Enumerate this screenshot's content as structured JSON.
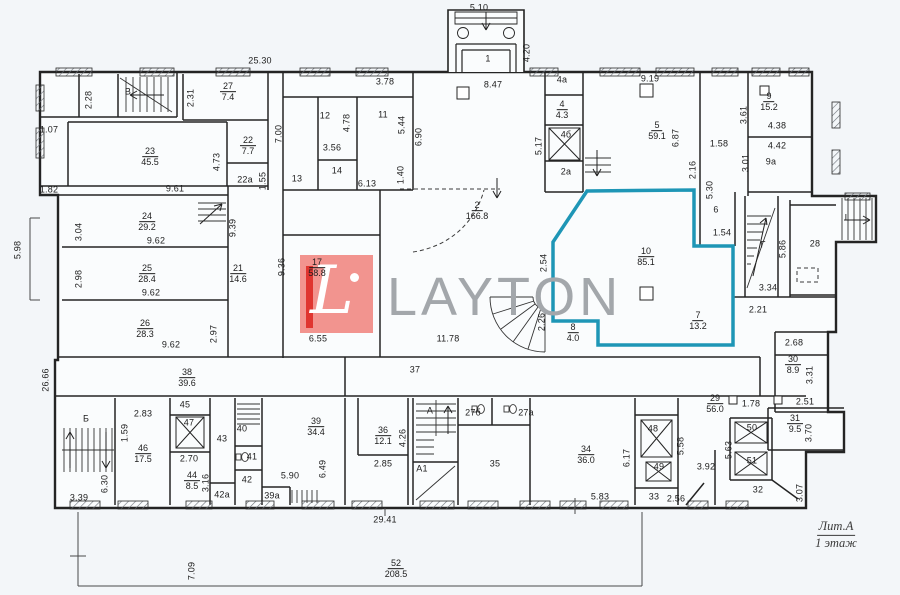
{
  "meta": {
    "logo_text": "LAYTON",
    "logo_letter": "L",
    "litera": "Лит.А",
    "floor": "1 этаж"
  },
  "colors": {
    "highlight_teal": "#1e96b6",
    "logo_pink": "#f2948f",
    "logo_red": "#e03530",
    "logo_grey": "#a3a7ab",
    "line": "#242424",
    "paper": "#fafcfd"
  },
  "highlighted_room": {
    "num": "10",
    "area": "85.1"
  },
  "rooms": [
    {
      "n": "27",
      "a": "7.4",
      "x": 228,
      "y": 92
    },
    {
      "n": "23",
      "a": "45.5",
      "x": 150,
      "y": 157
    },
    {
      "n": "22",
      "a": "7.7",
      "x": 248,
      "y": 146
    },
    {
      "n": "4",
      "a": "4.3",
      "x": 562,
      "y": 110
    },
    {
      "n": "5",
      "a": "59.1",
      "x": 657,
      "y": 131
    },
    {
      "n": "9",
      "a": "15.2",
      "x": 769,
      "y": 102
    },
    {
      "n": "24",
      "a": "29.2",
      "x": 147,
      "y": 222
    },
    {
      "n": "25",
      "a": "28.4",
      "x": 147,
      "y": 274
    },
    {
      "n": "26",
      "a": "28.3",
      "x": 145,
      "y": 329
    },
    {
      "n": "21",
      "a": "14.6",
      "x": 238,
      "y": 274
    },
    {
      "n": "17",
      "a": "58.8",
      "x": 317,
      "y": 268
    },
    {
      "n": "2",
      "a": "166.8",
      "x": 477,
      "y": 211
    },
    {
      "n": "10",
      "a": "85.1",
      "x": 646,
      "y": 257
    },
    {
      "n": "7",
      "a": "13.2",
      "x": 698,
      "y": 321
    },
    {
      "n": "8",
      "a": "4.0",
      "x": 573,
      "y": 333
    },
    {
      "n": "38",
      "a": "39.6",
      "x": 187,
      "y": 378
    },
    {
      "n": "46",
      "a": "17.5",
      "x": 143,
      "y": 454
    },
    {
      "n": "44",
      "a": "8.5",
      "x": 192,
      "y": 481
    },
    {
      "n": "39",
      "a": "34.4",
      "x": 316,
      "y": 427
    },
    {
      "n": "36",
      "a": "12.1",
      "x": 383,
      "y": 436
    },
    {
      "n": "34",
      "a": "36.0",
      "x": 586,
      "y": 455
    },
    {
      "n": "29",
      "a": "56.0",
      "x": 715,
      "y": 404
    },
    {
      "n": "31",
      "a": "9.5",
      "x": 795,
      "y": 424
    },
    {
      "n": "30",
      "a": "8.9",
      "x": 793,
      "y": 365
    },
    {
      "n": "52",
      "a": "208.5",
      "x": 396,
      "y": 569
    }
  ],
  "labels": [
    {
      "t": "25.30",
      "x": 260,
      "y": 61
    },
    {
      "t": "5.10",
      "x": 479,
      "y": 8
    },
    {
      "t": "4.20",
      "x": 527,
      "y": 53,
      "r": 1
    },
    {
      "t": "8.47",
      "x": 493,
      "y": 85
    },
    {
      "t": "3.78",
      "x": 385,
      "y": 82
    },
    {
      "t": "1",
      "x": 488,
      "y": 59
    },
    {
      "t": "2.28",
      "x": 89,
      "y": 100,
      "r": 1
    },
    {
      "t": "В",
      "x": 128,
      "y": 92
    },
    {
      "t": "2.31",
      "x": 191,
      "y": 98,
      "r": 1
    },
    {
      "t": "1.07",
      "x": 49,
      "y": 130
    },
    {
      "t": "1.82",
      "x": 49,
      "y": 190
    },
    {
      "t": "7.00",
      "x": 279,
      "y": 134,
      "r": 1
    },
    {
      "t": "4.73",
      "x": 217,
      "y": 162,
      "r": 1
    },
    {
      "t": "22а",
      "x": 245,
      "y": 180
    },
    {
      "t": "1.55",
      "x": 263,
      "y": 181,
      "r": 1
    },
    {
      "t": "9.61",
      "x": 175,
      "y": 189
    },
    {
      "t": "12",
      "x": 325,
      "y": 116
    },
    {
      "t": "11",
      "x": 383,
      "y": 115
    },
    {
      "t": "4.78",
      "x": 347,
      "y": 123,
      "r": 1
    },
    {
      "t": "5.44",
      "x": 402,
      "y": 125,
      "r": 1
    },
    {
      "t": "6.90",
      "x": 419,
      "y": 137,
      "r": 1
    },
    {
      "t": "3.56",
      "x": 332,
      "y": 148
    },
    {
      "t": "14",
      "x": 337,
      "y": 171
    },
    {
      "t": "13",
      "x": 297,
      "y": 179
    },
    {
      "t": "6.13",
      "x": 367,
      "y": 184
    },
    {
      "t": "1.40",
      "x": 401,
      "y": 175,
      "r": 1
    },
    {
      "t": "5.17",
      "x": 539,
      "y": 146,
      "r": 1
    },
    {
      "t": "4а",
      "x": 562,
      "y": 80
    },
    {
      "t": "4б",
      "x": 566,
      "y": 135
    },
    {
      "t": "2а",
      "x": 566,
      "y": 172
    },
    {
      "t": "9.19",
      "x": 650,
      "y": 79
    },
    {
      "t": "6.87",
      "x": 676,
      "y": 138,
      "r": 1
    },
    {
      "t": "1.58",
      "x": 719,
      "y": 144
    },
    {
      "t": "2.16",
      "x": 693,
      "y": 170,
      "r": 1
    },
    {
      "t": "5.30",
      "x": 710,
      "y": 190,
      "r": 1
    },
    {
      "t": "3.61",
      "x": 744,
      "y": 115,
      "r": 1
    },
    {
      "t": "3.01",
      "x": 746,
      "y": 163,
      "r": 1
    },
    {
      "t": "4.38",
      "x": 777,
      "y": 126
    },
    {
      "t": "4.42",
      "x": 777,
      "y": 146
    },
    {
      "t": "9а",
      "x": 771,
      "y": 162
    },
    {
      "t": "6",
      "x": 716,
      "y": 210
    },
    {
      "t": "1.54",
      "x": 722,
      "y": 233
    },
    {
      "t": "I",
      "x": 846,
      "y": 218
    },
    {
      "t": "Г",
      "x": 763,
      "y": 245
    },
    {
      "t": "5.86",
      "x": 783,
      "y": 249,
      "r": 1
    },
    {
      "t": "28",
      "x": 815,
      "y": 244
    },
    {
      "t": "3.34",
      "x": 768,
      "y": 288
    },
    {
      "t": "2.21",
      "x": 758,
      "y": 310
    },
    {
      "t": "2.68",
      "x": 794,
      "y": 343
    },
    {
      "t": "3.31",
      "x": 810,
      "y": 375,
      "r": 1
    },
    {
      "t": "3.04",
      "x": 79,
      "y": 232,
      "r": 1
    },
    {
      "t": "9.62",
      "x": 156,
      "y": 241
    },
    {
      "t": "2.98",
      "x": 79,
      "y": 279,
      "r": 1
    },
    {
      "t": "9.62",
      "x": 151,
      "y": 293
    },
    {
      "t": "9.62",
      "x": 171,
      "y": 345
    },
    {
      "t": "2.97",
      "x": 214,
      "y": 334,
      "r": 1
    },
    {
      "t": "9.39",
      "x": 233,
      "y": 228,
      "r": 1
    },
    {
      "t": "9.36",
      "x": 282,
      "y": 267,
      "r": 1
    },
    {
      "t": "5.98",
      "x": 18,
      "y": 250,
      "r": 1
    },
    {
      "t": "26.66",
      "x": 46,
      "y": 380,
      "r": 1
    },
    {
      "t": "2.54",
      "x": 544,
      "y": 263,
      "r": 1
    },
    {
      "t": "2.26",
      "x": 542,
      "y": 322,
      "r": 1
    },
    {
      "t": "6.55",
      "x": 318,
      "y": 339
    },
    {
      "t": "11.78",
      "x": 448,
      "y": 339
    },
    {
      "t": "37",
      "x": 415,
      "y": 370
    },
    {
      "t": "Б",
      "x": 86,
      "y": 419
    },
    {
      "t": "2.83",
      "x": 143,
      "y": 414
    },
    {
      "t": "1.59",
      "x": 125,
      "y": 433,
      "r": 1
    },
    {
      "t": "45",
      "x": 185,
      "y": 405
    },
    {
      "t": "47",
      "x": 189,
      "y": 423
    },
    {
      "t": "43",
      "x": 222,
      "y": 439
    },
    {
      "t": "40",
      "x": 242,
      "y": 429
    },
    {
      "t": "41",
      "x": 252,
      "y": 457
    },
    {
      "t": "42",
      "x": 247,
      "y": 480
    },
    {
      "t": "42а",
      "x": 222,
      "y": 495
    },
    {
      "t": "3.16",
      "x": 206,
      "y": 483,
      "r": 1
    },
    {
      "t": "2.70",
      "x": 189,
      "y": 459
    },
    {
      "t": "6.30",
      "x": 105,
      "y": 484,
      "r": 1
    },
    {
      "t": "3.39",
      "x": 79,
      "y": 498
    },
    {
      "t": "5.90",
      "x": 290,
      "y": 476
    },
    {
      "t": "6.49",
      "x": 323,
      "y": 469,
      "r": 1
    },
    {
      "t": "39а",
      "x": 272,
      "y": 496
    },
    {
      "t": "4.26",
      "x": 403,
      "y": 438,
      "r": 1
    },
    {
      "t": "2.85",
      "x": 383,
      "y": 464
    },
    {
      "t": "А",
      "x": 430,
      "y": 411
    },
    {
      "t": "А1",
      "x": 422,
      "y": 469
    },
    {
      "t": "27б",
      "x": 473,
      "y": 413
    },
    {
      "t": "27а",
      "x": 526,
      "y": 413
    },
    {
      "t": "35",
      "x": 495,
      "y": 464
    },
    {
      "t": "6.17",
      "x": 627,
      "y": 458,
      "r": 1
    },
    {
      "t": "5.83",
      "x": 600,
      "y": 497
    },
    {
      "t": "48",
      "x": 653,
      "y": 429
    },
    {
      "t": "49",
      "x": 659,
      "y": 467
    },
    {
      "t": "5.58",
      "x": 681,
      "y": 446,
      "r": 1
    },
    {
      "t": "33",
      "x": 654,
      "y": 497
    },
    {
      "t": "2.56",
      "x": 676,
      "y": 499
    },
    {
      "t": "1.78",
      "x": 751,
      "y": 404
    },
    {
      "t": "2.51",
      "x": 805,
      "y": 402
    },
    {
      "t": "3.70",
      "x": 809,
      "y": 433,
      "r": 1
    },
    {
      "t": "5.63",
      "x": 729,
      "y": 450,
      "r": 1
    },
    {
      "t": "3.92",
      "x": 706,
      "y": 467
    },
    {
      "t": "50",
      "x": 752,
      "y": 428
    },
    {
      "t": "51",
      "x": 752,
      "y": 461
    },
    {
      "t": "32",
      "x": 758,
      "y": 490
    },
    {
      "t": "3.07",
      "x": 800,
      "y": 493,
      "r": 1
    },
    {
      "t": "29.41",
      "x": 385,
      "y": 520
    },
    {
      "t": "7.09",
      "x": 192,
      "y": 571,
      "r": 1
    }
  ]
}
